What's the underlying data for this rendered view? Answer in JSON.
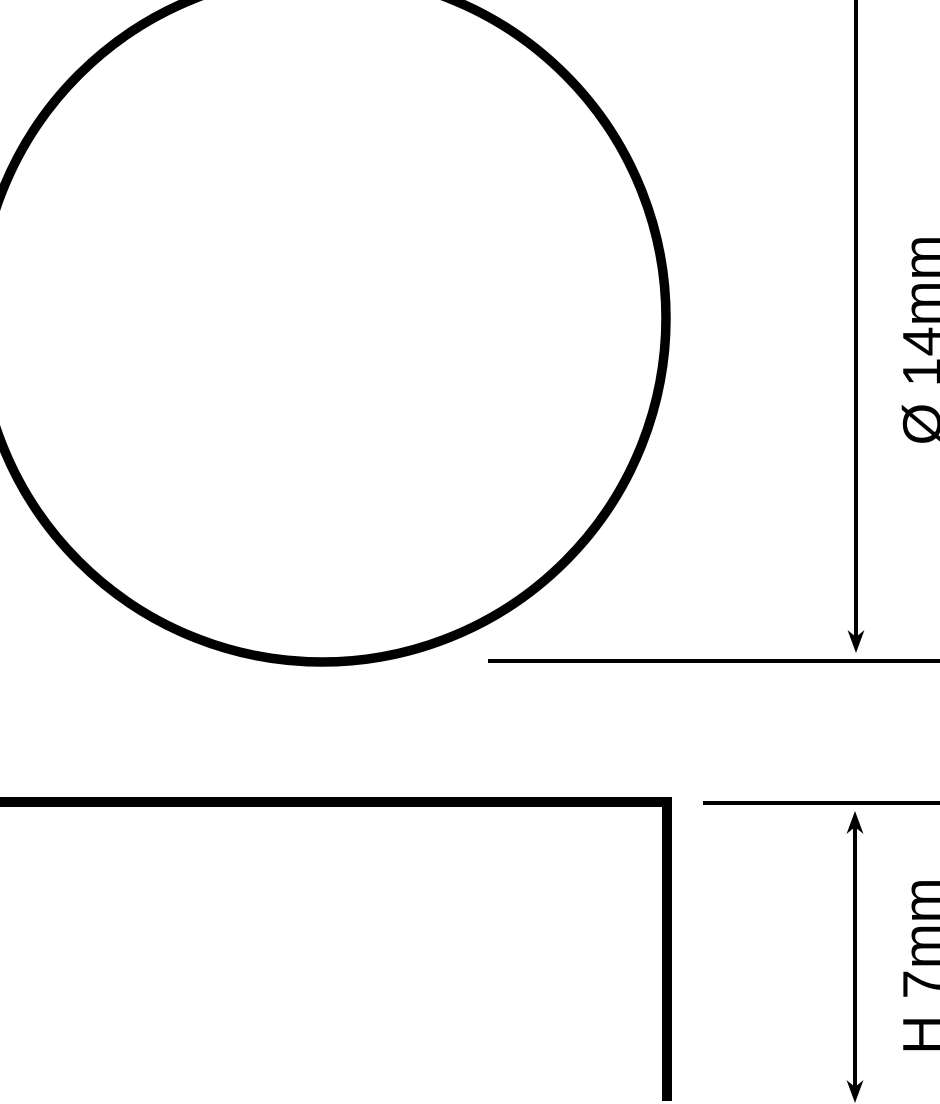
{
  "diagram": {
    "type": "technical-dimension-drawing",
    "background_color": "#ffffff",
    "line_color": "#000000",
    "top_view": {
      "shape": "circle",
      "dimension_label": "Ø 14mm",
      "dimension_symbol": "Ø",
      "dimension_value": "14mm"
    },
    "side_view": {
      "shape": "rectangle",
      "dimension_label": "H 7mm",
      "dimension_symbol": "H",
      "dimension_value": "7mm"
    }
  }
}
